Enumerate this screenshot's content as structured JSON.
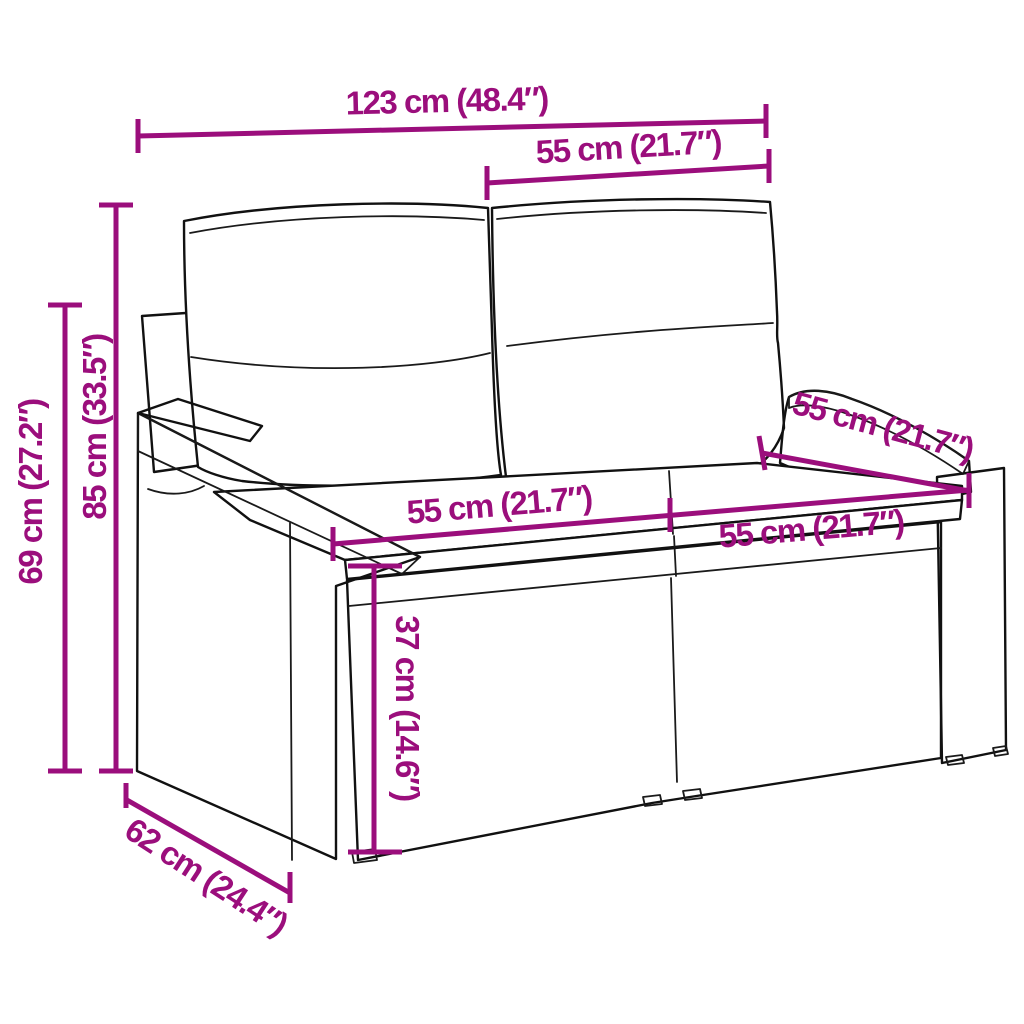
{
  "figure": {
    "subject": "2-seater poly rattan garden sofa with back cushions and seat cushions",
    "style": "black line-art product drawing with magenta dimension annotations",
    "accent_color": "#9B0E7C",
    "ink_color": "#111111",
    "background_color": "#FFFFFF"
  },
  "dimensions": [
    {
      "id": "overall-width",
      "label": "123 cm (48.4″)",
      "orientation": "horizontal"
    },
    {
      "id": "backrest-cushion-width",
      "label": "55 cm (21.7″)",
      "orientation": "horizontal"
    },
    {
      "id": "overall-height",
      "label": "85 cm (33.5″)",
      "orientation": "vertical"
    },
    {
      "id": "back-post-height",
      "label": "69 cm (27.2″)",
      "orientation": "vertical"
    },
    {
      "id": "seat-width-left",
      "label": "55 cm (21.7″)",
      "orientation": "horizontal"
    },
    {
      "id": "seat-width-right",
      "label": "55 cm (21.7″)",
      "orientation": "horizontal"
    },
    {
      "id": "seat-depth",
      "label": "55 cm (21.7″)",
      "orientation": "diagonal"
    },
    {
      "id": "seat-height",
      "label": "37 cm (14.6″)",
      "orientation": "vertical"
    },
    {
      "id": "overall-depth",
      "label": "62 cm (24.4″)",
      "orientation": "diagonal"
    }
  ]
}
